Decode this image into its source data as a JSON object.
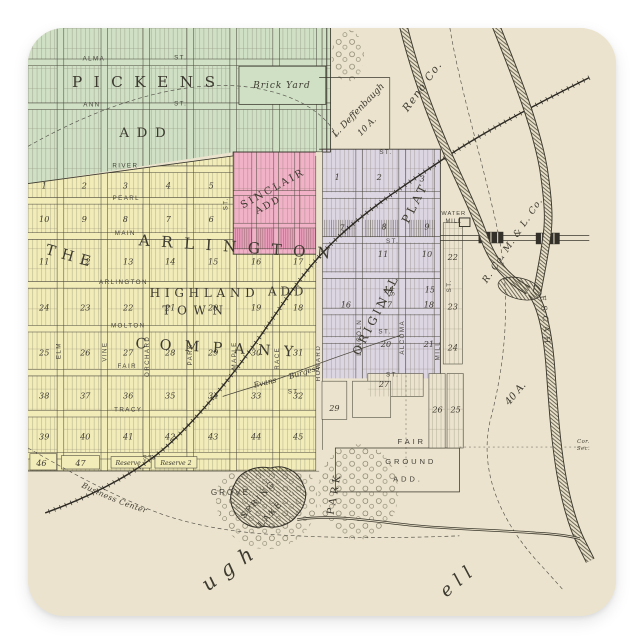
{
  "map": {
    "additions": {
      "pickens": "PICKENS",
      "pickens_add": "ADD",
      "the": "THE",
      "arlington": "ARLINGTON",
      "highland": "HIGHLAND",
      "highland_add": "ADD",
      "town": "TOWN",
      "company": "COMPANY",
      "sinclair": "SINCLAIR",
      "sinclair_add": "ADD",
      "original": "ORIGINAL",
      "plat": "PLAT",
      "fair": "FAIR",
      "ground": "GROUND",
      "ground_add": "ADD."
    },
    "streets": {
      "alma": "ALMA",
      "ann": "ANN",
      "river": "RIVER",
      "pearl": "PEARL",
      "main": "MAIN",
      "arlington_st": "ARLINGTON",
      "molton": "MOLTON",
      "fair_st": "FAIR",
      "tracy": "TRACY",
      "elm": "ELM",
      "vine": "VINE",
      "orchard": "ORCHARD",
      "park_st": "PARK",
      "maple": "MAPLE",
      "race": "RACE",
      "howard": "HOWARD",
      "lincoln": "LINCOLN",
      "alcoma": "ALCOMA",
      "mill": "MILL",
      "st": "ST."
    },
    "labels": {
      "brick_yard": "Brick Yard",
      "water": "WATER",
      "mill_b": "MILL",
      "deffenbaugh": "L. Deffenbaugh",
      "ten_a": "10 A.",
      "reno_co": "Reno Co.",
      "rcoml": "R. Co. M. & L. Co.",
      "forty_a": "40 A.",
      "ninnescah": "NINNESCAH",
      "cor": "Cor.",
      "sec": "Sec.",
      "reserve1": "Reserve 1",
      "reserve2": "Reserve 2",
      "burgess": "Burgess",
      "evans": "Evans",
      "business_center": "¾ of M. From Business Center",
      "grove": "GROVE",
      "spring": "SPRING",
      "lake": "LAKE",
      "park": "PARK",
      "baugh": "baugh",
      "bell": "bell"
    },
    "blocks": {
      "r1": [
        "1",
        "2",
        "3",
        "4",
        "5"
      ],
      "r2": [
        "10",
        "9",
        "8",
        "7",
        "6"
      ],
      "r3": [
        "11",
        "12",
        "13",
        "14",
        "15",
        "16",
        "17"
      ],
      "r4": [
        "24",
        "23",
        "22",
        "21",
        "20",
        "19",
        "18"
      ],
      "r5": [
        "25",
        "26",
        "27",
        "28",
        "29",
        "30",
        "31"
      ],
      "r6": [
        "38",
        "37",
        "36",
        "35",
        "34",
        "33",
        "32"
      ],
      "r7": [
        "39",
        "40",
        "41",
        "42",
        "43",
        "44",
        "45"
      ],
      "r8": [
        "46",
        "47"
      ],
      "orig": [
        "1",
        "2",
        "3",
        "7",
        "8",
        "9",
        "11",
        "10",
        "14",
        "15",
        "16",
        "17",
        "18",
        "20",
        "21",
        "22",
        "23",
        "24",
        "27",
        "29",
        "26",
        "25"
      ]
    }
  }
}
